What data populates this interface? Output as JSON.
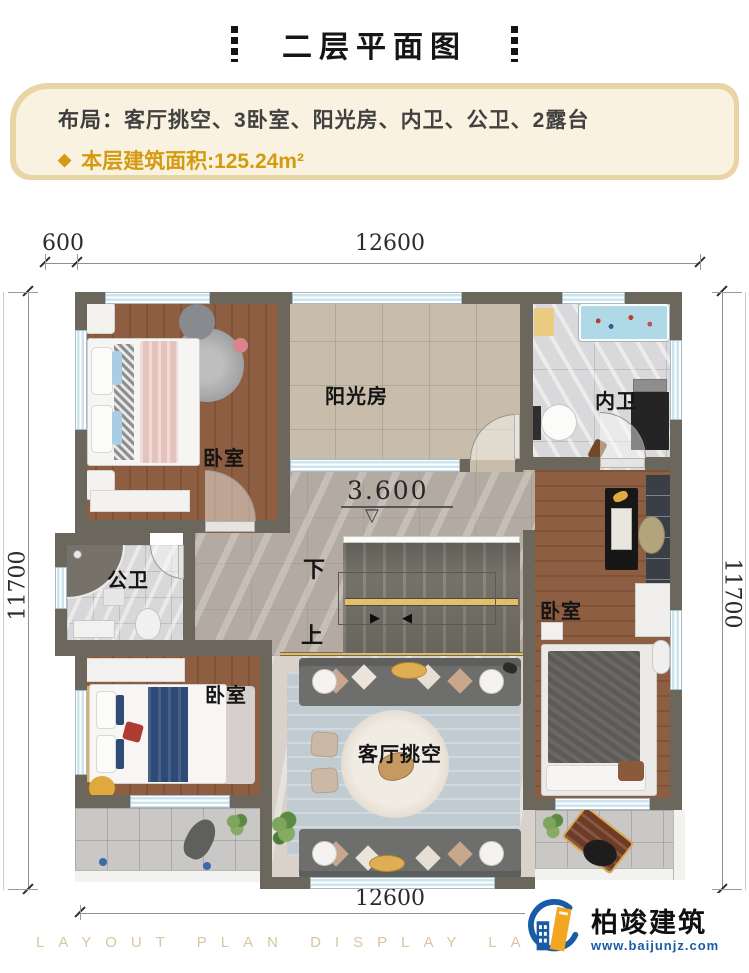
{
  "header": {
    "title": "二层平面图"
  },
  "info": {
    "layout_label": "布局：",
    "layout_value": "客厅挑空、3卧室、阳光房、内卫、公卫、2露台",
    "bullet": "◆",
    "area_text": "本层建筑面积:125.24m²"
  },
  "dims": {
    "top_small": "600",
    "top_main": "12600",
    "left": "11700",
    "right": "11700",
    "bottom": "12600"
  },
  "plan": {
    "rooms": {
      "bedroom_tl": "卧室",
      "sunroom": "阳光房",
      "bath_inner": "内卫",
      "bath_public": "公卫",
      "bedroom_right": "卧室",
      "bedroom_bl": "卧室",
      "living": "客厅挑空"
    },
    "stairs": {
      "down": "下",
      "up": "上",
      "arrow_right": "▶",
      "arrow_left": "◀"
    },
    "level": {
      "value": "3.600",
      "marker": "▽"
    }
  },
  "footer": {
    "strip": "LAYOUT PLAN DISPLAY LAYOUT PLAN DISPLAY",
    "brand": "柏竣建筑",
    "url": "www.baijunjz.com"
  },
  "colors": {
    "accent_gold": "#d49a10",
    "wall": "#6c675d",
    "window": "#cde3ed",
    "wood": "#8a5c3e",
    "stair_gold": "#e5bf68",
    "brand_blue": "#1a5ba6",
    "brand_orange": "#f2a51f"
  }
}
